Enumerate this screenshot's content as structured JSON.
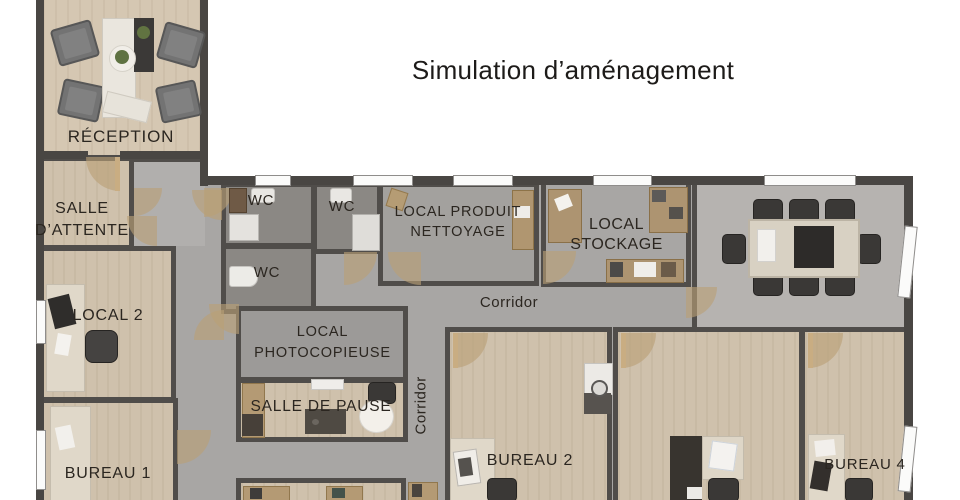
{
  "title": "Simulation d’aménagement",
  "rooms": {
    "reception": "RÉCEPTION",
    "salle_attente": "SALLE\nD’ATTENTE",
    "wc_top": "WC",
    "wc_middle": "WC",
    "wc_bottom": "WC",
    "local_produit": "LOCAL PRODUIT\nNETTOYAGE",
    "local_stockage": "LOCAL STOCKAGE",
    "corridor_main": "Corridor",
    "corridor_vertical": "Corridor",
    "local_2": "LOCAL 2",
    "photocopieuse": "LOCAL\nPHOTOCOPIEUSE",
    "salle_de_pause": "SALLE DE PAUSE",
    "bureau_1": "BUREAU 1",
    "bureau_2": "BUREAU 2",
    "bureau_4": "BUREAU 4"
  },
  "colors": {
    "wall": "#504d4a",
    "floor_wood": "#cfc1ac",
    "floor_corridor": "#a8a6a4",
    "floor_wc": "#8b8884",
    "floor_meeting": "#b6b3b0",
    "door": "#c9ad82",
    "label_text": "#2b2620"
  }
}
